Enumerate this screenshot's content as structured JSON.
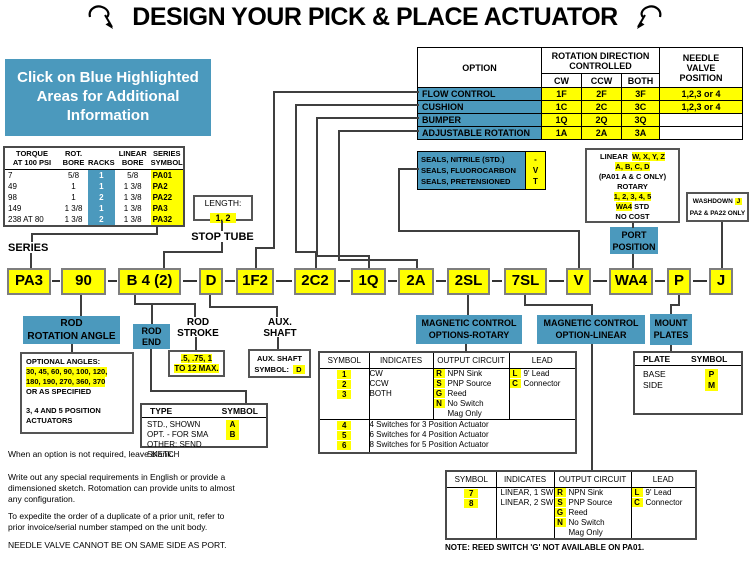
{
  "title": "DESIGN YOUR PICK & PLACE ACTUATOR",
  "info_box": "Click on Blue Highlighted\nAreas for Additional\nInformation",
  "options_table": {
    "col_option": "OPTION",
    "col_rotation": "ROTATION DIRECTION\nCONTROLLED",
    "col_cw": "CW",
    "col_ccw": "CCW",
    "col_both": "BOTH",
    "col_needle": "NEEDLE\nVALVE\nPOSITION",
    "rows": [
      {
        "option": "FLOW CONTROL",
        "cw": "1F",
        "ccw": "2F",
        "both": "3F",
        "needle": "1,2,3 or 4"
      },
      {
        "option": "CUSHION",
        "cw": "1C",
        "ccw": "2C",
        "both": "3C",
        "needle": "1,2,3 or 4"
      },
      {
        "option": "BUMPER",
        "cw": "1Q",
        "ccw": "2Q",
        "both": "3Q",
        "needle": ""
      },
      {
        "option": "ADJUSTABLE ROTATION",
        "cw": "1A",
        "ccw": "2A",
        "both": "3A",
        "needle": ""
      }
    ]
  },
  "series_table": {
    "h_torque": "TORQUE\nAT 100 PSI",
    "h_rot_bore": "ROT.\nBORE",
    "h_racks": "RACKS",
    "h_linear_bore": "LINEAR\nBORE",
    "h_symbol": "SERIES\nSYMBOL",
    "rows": [
      {
        "torque": "7",
        "rot_bore": "5/8",
        "racks": "1",
        "linear_bore": "5/8",
        "symbol": "PA01"
      },
      {
        "torque": "49",
        "rot_bore": "1",
        "racks": "1",
        "linear_bore": "1 3/8",
        "symbol": "PA2"
      },
      {
        "torque": "98",
        "rot_bore": "1",
        "racks": "2",
        "linear_bore": "1 3/8",
        "symbol": "PA22"
      },
      {
        "torque": "149",
        "rot_bore": "1 3/8",
        "racks": "1",
        "linear_bore": "1 3/8",
        "symbol": "PA3"
      },
      {
        "torque": "238 AT 80",
        "rot_bore": "1 3/8",
        "racks": "2",
        "linear_bore": "1 3/8",
        "symbol": "PA32"
      }
    ],
    "label": "SERIES"
  },
  "stop_tube": {
    "box_label": "LENGTH:",
    "box_value": "1, 2",
    "label": "STOP TUBE"
  },
  "seals": {
    "rows": [
      {
        "label": "SEALS, NITRILE (STD.)",
        "symbol": "-"
      },
      {
        "label": "SEALS, FLUOROCARBON",
        "symbol": "V"
      },
      {
        "label": "SEALS, PRETENSIONED",
        "symbol": "T"
      }
    ]
  },
  "port_options": {
    "linear_label": "LINEAR",
    "linear_codes1": "W, X, Y, Z",
    "linear_codes2": "A, B, C, D",
    "linear_note": "(PA01 A & C ONLY)",
    "rotary_label": "ROTARY",
    "rotary_codes": "1, 2, 3, 4, 5",
    "std_code": "WA4",
    "std_label": "STD",
    "cost_note": "NO COST"
  },
  "port_position_label": "PORT\nPOSITION",
  "washdown": {
    "label": "WASHDOWN",
    "symbol": "J",
    "note": "PA2 & PA22 ONLY"
  },
  "code_row": {
    "segments": [
      "PA3",
      "90",
      "B 4 (2)",
      "D",
      "1F2",
      "2C2",
      "1Q",
      "2A",
      "2SL",
      "7SL",
      "V",
      "WA4",
      "P",
      "J"
    ]
  },
  "rod_rotation": {
    "label": "ROD\nROTATION ANGLE",
    "angles_title": "OPTIONAL ANGLES:",
    "angles_line1": "30, 45, 60, 90, 100, 120,",
    "angles_line2": "180, 190, 270, 360, 370",
    "angles_line3": "OR AS SPECIFIED",
    "angles_line4": "3, 4 AND 5 POSITION\nACTUATORS"
  },
  "rod_end": {
    "label": "ROD\nEND",
    "type_header": "TYPE",
    "symbol_header": "SYMBOL",
    "rows": [
      {
        "type": "STD., SHOWN",
        "symbol": "A"
      },
      {
        "type": "OPT. - FOR SMA",
        "symbol": "B"
      },
      {
        "type": "OTHER: SEND SKETCH",
        "symbol": ""
      }
    ]
  },
  "rod_stroke": {
    "label": "ROD\nSTROKE",
    "value_line1": ".5, .75, 1",
    "value_line2": "TO 12 MAX."
  },
  "aux_shaft": {
    "label": "AUX.\nSHAFT",
    "box_line1": "AUX. SHAFT",
    "box_line2": "SYMBOL:",
    "symbol": "D"
  },
  "magnetic_rotary": {
    "label": "MAGNETIC CONTROL\nOPTIONS-ROTARY",
    "h_symbol": "SYMBOL",
    "h_indicates": "INDICATES",
    "h_output": "OUTPUT CIRCUIT",
    "h_lead": "LEAD",
    "symbols": [
      "1",
      "2",
      "3"
    ],
    "indicates": [
      "CW",
      "CCW",
      "BOTH"
    ],
    "output": [
      {
        "code": "R",
        "desc": "NPN Sink"
      },
      {
        "code": "S",
        "desc": "PNP Source"
      },
      {
        "code": "G",
        "desc": "Reed"
      },
      {
        "code": "N",
        "desc": "No Switch"
      },
      {
        "code": "",
        "desc": "Mag Only"
      }
    ],
    "lead": [
      {
        "code": "L",
        "desc": "9' Lead"
      },
      {
        "code": "C",
        "desc": "Connector"
      }
    ],
    "extra": [
      {
        "symbol": "4",
        "desc": "4 Switches for 3 Position Actuator"
      },
      {
        "symbol": "5",
        "desc": "6 Switches for 4 Position Actuator"
      },
      {
        "symbol": "6",
        "desc": "8 Switches for 5 Position Actuator"
      }
    ]
  },
  "magnetic_linear": {
    "label": "MAGNETIC CONTROL\nOPTION-LINEAR",
    "h_symbol": "SYMBOL",
    "h_indicates": "INDICATES",
    "h_output": "OUTPUT CIRCUIT",
    "h_lead": "LEAD",
    "symbols": [
      "7",
      "8"
    ],
    "indicates": [
      "LINEAR, 1 SW",
      "LINEAR, 2 SW"
    ],
    "output": [
      {
        "code": "R",
        "desc": "NPN Sink"
      },
      {
        "code": "S",
        "desc": "PNP Source"
      },
      {
        "code": "G",
        "desc": "Reed"
      },
      {
        "code": "N",
        "desc": "No Switch"
      },
      {
        "code": "",
        "desc": "Mag Only"
      }
    ],
    "lead": [
      {
        "code": "L",
        "desc": "9' Lead"
      },
      {
        "code": "C",
        "desc": "Connector"
      }
    ],
    "note": "NOTE: REED SWITCH 'G' NOT AVAILABLE ON PA01."
  },
  "mount_plates": {
    "label": "MOUNT\nPLATES",
    "h_plate": "PLATE",
    "h_symbol": "SYMBOL",
    "rows": [
      {
        "plate": "BASE",
        "symbol": "P"
      },
      {
        "plate": "SIDE",
        "symbol": "M"
      }
    ]
  },
  "footnotes": [
    "When an option is not required, leave blank.",
    "Write out any special requirements in English or provide a\ndimensioned sketch. Rotomation can provide units to almost\nany configuration.",
    "To expedite the order of a duplicate of a prior unit, refer to\nprior invoice/serial number stamped on the unit body.",
    "NEEDLE VALVE CANNOT BE ON SAME SIDE AS PORT."
  ],
  "colors": {
    "highlight_blue": "#4b99bd",
    "highlight_yellow": "#ffff00"
  }
}
